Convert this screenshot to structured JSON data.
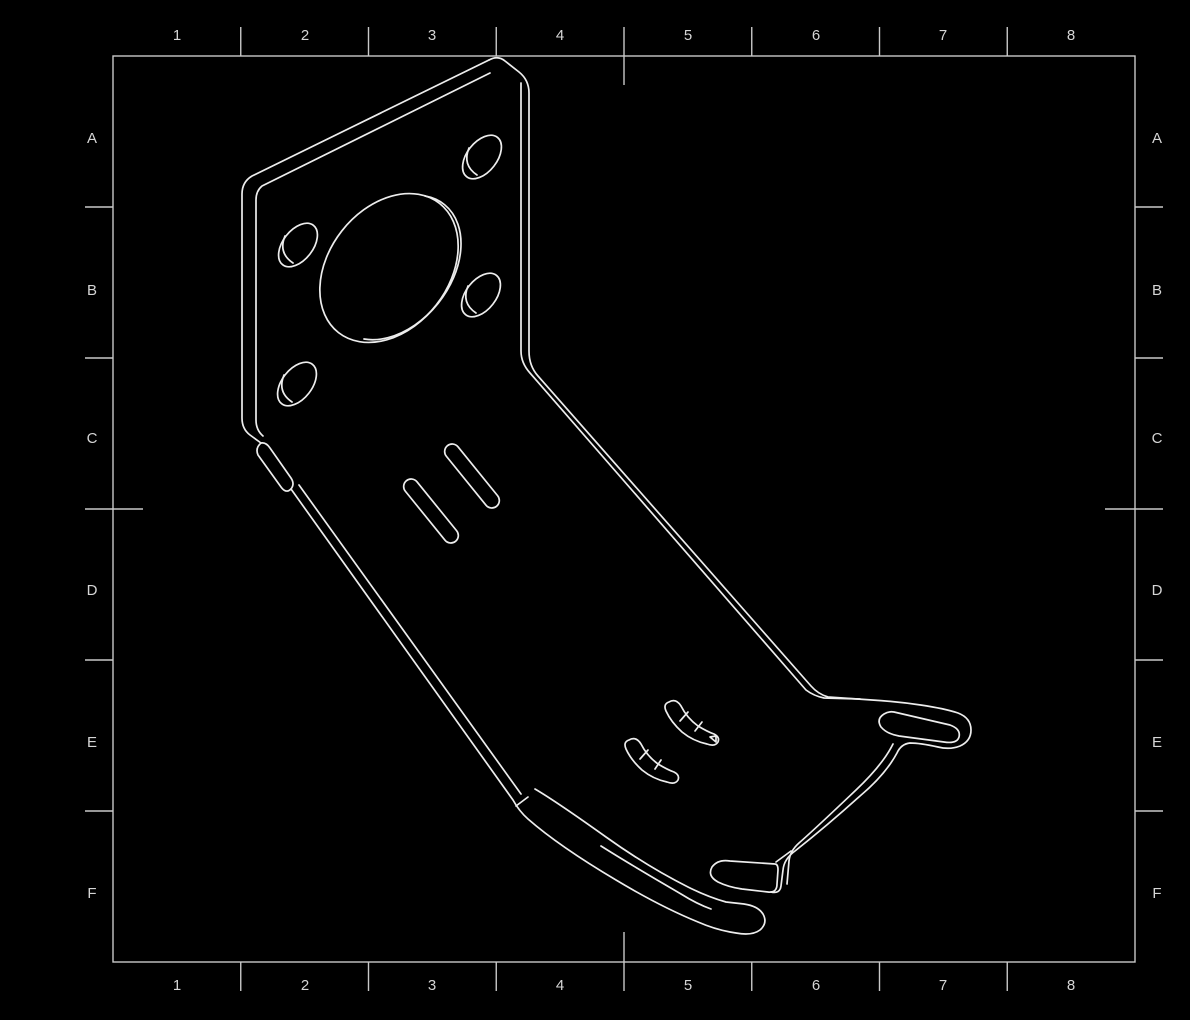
{
  "sheet": {
    "description": "CAD drawing sheet, isometric view of sheet-metal motor-mount bracket",
    "background_color": "#000000",
    "frame_line_color": "#c9c9c9",
    "part_line_color": "#ededed",
    "zone_columns": [
      "1",
      "2",
      "3",
      "4",
      "5",
      "6",
      "7",
      "8"
    ],
    "zone_rows": [
      "A",
      "B",
      "C",
      "D",
      "E",
      "F"
    ]
  }
}
